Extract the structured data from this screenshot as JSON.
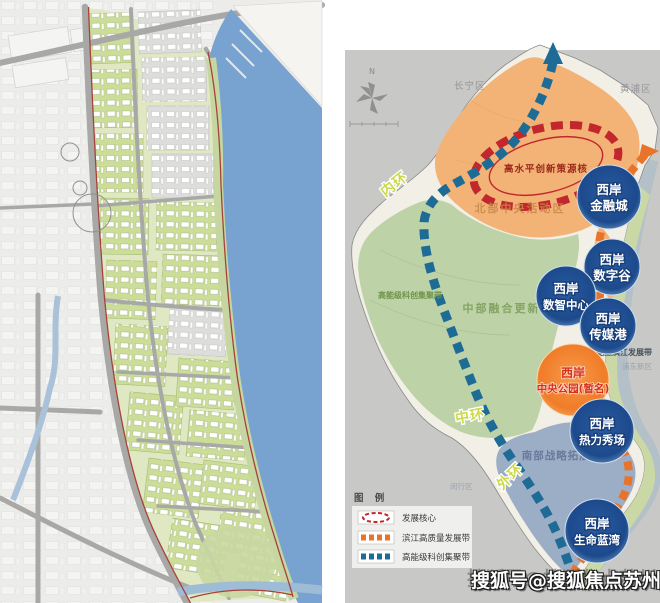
{
  "right_map": {
    "compass": "N",
    "district_labels": [
      "长宁区",
      "黄浦区",
      "浦东新区",
      "闵行区"
    ],
    "zone_labels": {
      "north": "北部中央活动区",
      "middle": "中部融合更新区",
      "south": "南部战略拓展区"
    },
    "core_label": "高水平创新策源核",
    "belt_labels": {
      "sci_tech": "高能级科创集聚带",
      "riverside": "能量滨江发展带"
    },
    "ring_labels": {
      "inner": "内环",
      "middle": "中环",
      "outer": "外环"
    },
    "nodes": [
      {
        "line1": "西岸",
        "line2": "金融城"
      },
      {
        "line1": "西岸",
        "line2": "数字谷"
      },
      {
        "line1": "西岸",
        "line2": "数智中心"
      },
      {
        "line1": "西岸",
        "line2": "传媒港"
      },
      {
        "line1": "西岸",
        "line2": "中央公园(暂名)"
      },
      {
        "line1": "西岸",
        "line2": "热力秀场"
      },
      {
        "line1": "西岸",
        "line2": "生命蓝湾"
      }
    ],
    "legend": {
      "title": "图 例",
      "items": [
        {
          "label": "发展核心"
        },
        {
          "label": "滨江高质量发展带"
        },
        {
          "label": "高能级科创集聚带"
        }
      ]
    }
  },
  "watermark": "搜狐号@搜狐焦点苏州站",
  "colors": {
    "sci_tech_belt": "#1e6b96",
    "riverside_belt": "#e8732a",
    "core_red": "#c1272d",
    "node_blue": "#1d4f93",
    "node_orange": "#f07c28",
    "ring_label": "#ccd94b",
    "north_zone": "#f3b377",
    "middle_zone": "#b9cfa2",
    "south_zone": "#8fa5c2",
    "water": "#78a2cf"
  }
}
